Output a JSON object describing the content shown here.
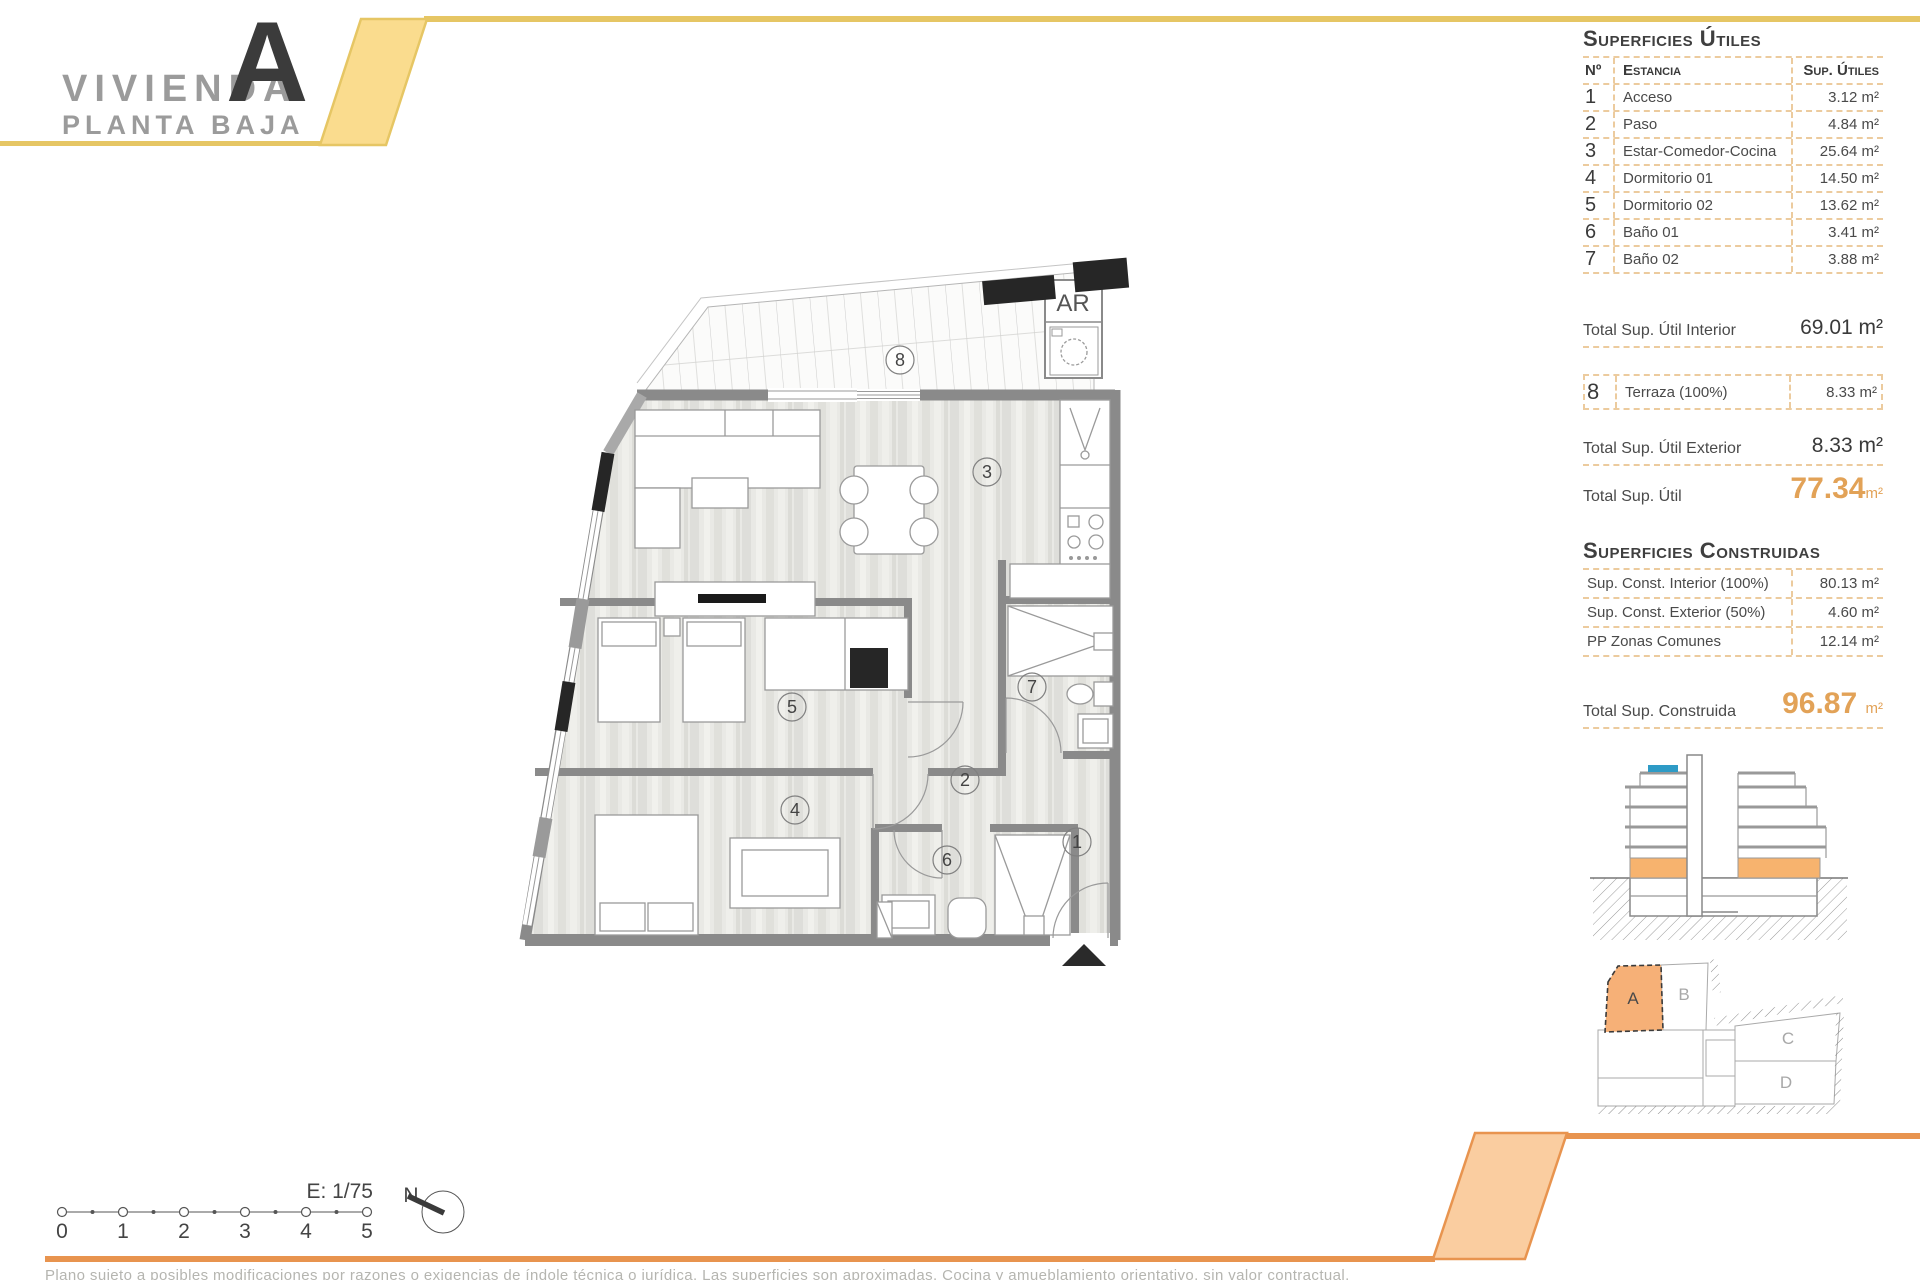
{
  "header": {
    "title": "VIVIENDA",
    "unit_letter": "A",
    "subtitle": "PLANTA BAJA"
  },
  "surfaces_utiles": {
    "title": "Superficies Útiles",
    "col_no": "Nº",
    "col_room": "Estancia",
    "col_area": "Sup. Útiles",
    "rows": [
      {
        "no": "1",
        "room": "Acceso",
        "area": "3.12 m²"
      },
      {
        "no": "2",
        "room": "Paso",
        "area": "4.84 m²"
      },
      {
        "no": "3",
        "room": "Estar-Comedor-Cocina",
        "area": "25.64 m²"
      },
      {
        "no": "4",
        "room": "Dormitorio 01",
        "area": "14.50 m²"
      },
      {
        "no": "5",
        "room": "Dormitorio 02",
        "area": "13.62 m²"
      },
      {
        "no": "6",
        "room": "Baño 01",
        "area": "3.41 m²"
      },
      {
        "no": "7",
        "room": "Baño 02",
        "area": "3.88 m²"
      }
    ],
    "total_interior_label": "Total Sup. Útil Interior",
    "total_interior_value": "69.01 m²",
    "terrace_row": {
      "no": "8",
      "room": "Terraza (100%)",
      "area": "8.33 m²"
    },
    "total_exterior_label": "Total Sup. Útil Exterior",
    "total_exterior_value": "8.33 m²",
    "total_label": "Total Sup. Útil",
    "total_value": "77.34",
    "total_unit": "m²"
  },
  "surfaces_construidas": {
    "title": "Superficies Construidas",
    "rows": [
      {
        "label": "Sup. Const. Interior (100%)",
        "value": "80.13 m²"
      },
      {
        "label": "Sup. Const. Exterior (50%)",
        "value": "4.60 m²"
      },
      {
        "label": "PP Zonas Comunes",
        "value": "12.14 m²"
      }
    ],
    "total_label": "Total Sup. Construida",
    "total_value": "96.87",
    "total_unit": "m²"
  },
  "plan": {
    "room_labels": [
      "1",
      "2",
      "3",
      "4",
      "5",
      "6",
      "7",
      "8"
    ],
    "ar_label": "AR"
  },
  "scale_bar": {
    "label": "E: 1/75",
    "ticks": [
      "0",
      "1",
      "2",
      "3",
      "4",
      "5"
    ],
    "north_label": "N"
  },
  "site_plan": {
    "units": [
      "A",
      "B",
      "C",
      "D"
    ]
  },
  "footer_note": "Plano sujeto a posibles modificaciones por razones o exigencias de índole técnica o jurídica. Las superficies son aproximadas. Cocina y amueblamiento orientativo, sin valor contractual.",
  "colors": {
    "accent_yellow": "#E6C664",
    "accent_yellow_fill": "#FADC8E",
    "accent_orange": "#E8944F",
    "accent_orange_fill": "#FACDA0",
    "value_orange": "#E2A257",
    "dash_tan": "#ECCB9E",
    "wall_gray": "#8A8A8A",
    "unit_a_fill": "#F6B077",
    "floor_orange": "#F7B36E",
    "pool_blue": "#2E9BC6"
  }
}
